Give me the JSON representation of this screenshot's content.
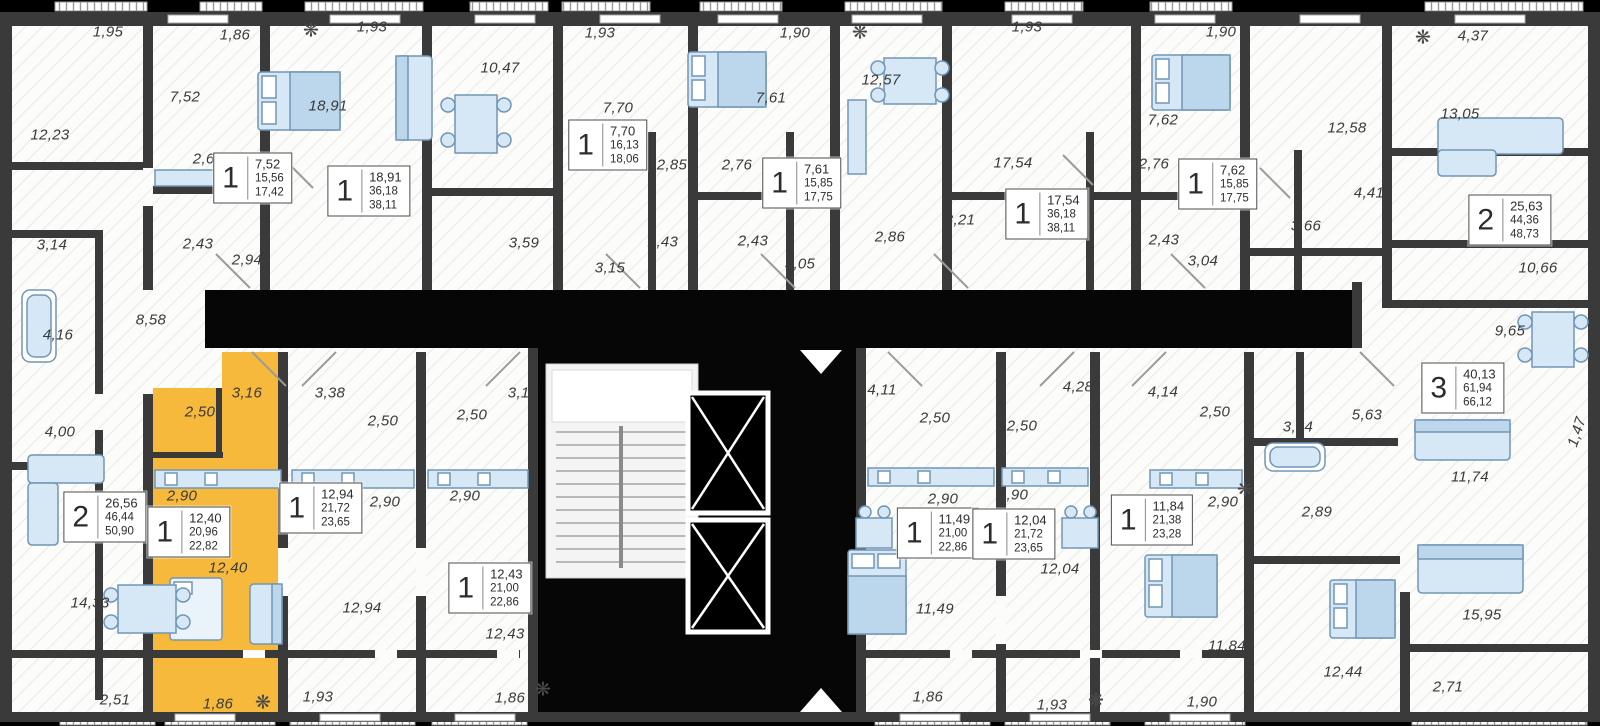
{
  "plan": {
    "type": "residential-floor-plan",
    "selected_apartment": {
      "rooms": "1",
      "areas": [
        "12,40",
        "20,96",
        "22,82"
      ]
    },
    "colors": {
      "highlight": "#F6B93C",
      "wall": "#3A3A3A",
      "shaft": "#000000",
      "furniture": "#D6E7F5"
    }
  },
  "room_labels": [
    {
      "text": "1,95",
      "x": 108,
      "y": 32
    },
    {
      "text": "1,86",
      "x": 235,
      "y": 35
    },
    {
      "text": "1,93",
      "x": 372,
      "y": 27
    },
    {
      "text": "10,47",
      "x": 500,
      "y": 68
    },
    {
      "text": "1,93",
      "x": 600,
      "y": 33
    },
    {
      "text": "1,90",
      "x": 795,
      "y": 33
    },
    {
      "text": "1,93",
      "x": 1027,
      "y": 27
    },
    {
      "text": "1,90",
      "x": 1221,
      "y": 32
    },
    {
      "text": "4,37",
      "x": 1473,
      "y": 36
    },
    {
      "text": "7,52",
      "x": 185,
      "y": 97
    },
    {
      "text": "12,23",
      "x": 50,
      "y": 135
    },
    {
      "text": "18,91",
      "x": 328,
      "y": 106
    },
    {
      "text": "7,70",
      "x": 618,
      "y": 108
    },
    {
      "text": "7,61",
      "x": 771,
      "y": 98
    },
    {
      "text": "12,57",
      "x": 881,
      "y": 80
    },
    {
      "text": "7,62",
      "x": 1163,
      "y": 120
    },
    {
      "text": "12,58",
      "x": 1347,
      "y": 128
    },
    {
      "text": "13,05",
      "x": 1460,
      "y": 114
    },
    {
      "text": "2,67",
      "x": 208,
      "y": 159
    },
    {
      "text": "2,85",
      "x": 672,
      "y": 165
    },
    {
      "text": "2,76",
      "x": 737,
      "y": 165
    },
    {
      "text": "17,54",
      "x": 1013,
      "y": 163
    },
    {
      "text": "2,76",
      "x": 1154,
      "y": 164
    },
    {
      "text": "4,41",
      "x": 1369,
      "y": 193
    },
    {
      "text": "3,66",
      "x": 1306,
      "y": 226
    },
    {
      "text": "3,14",
      "x": 52,
      "y": 245
    },
    {
      "text": "2,43",
      "x": 198,
      "y": 244
    },
    {
      "text": "2,94",
      "x": 247,
      "y": 260
    },
    {
      "text": "3,59",
      "x": 524,
      "y": 243
    },
    {
      "text": "2,43",
      "x": 663,
      "y": 242
    },
    {
      "text": "2,43",
      "x": 753,
      "y": 241
    },
    {
      "text": "2,86",
      "x": 890,
      "y": 237
    },
    {
      "text": "3,21",
      "x": 960,
      "y": 220
    },
    {
      "text": "2,43",
      "x": 1164,
      "y": 240
    },
    {
      "text": "3,04",
      "x": 1203,
      "y": 261
    },
    {
      "text": "3,15",
      "x": 610,
      "y": 268
    },
    {
      "text": "3,05",
      "x": 800,
      "y": 264
    },
    {
      "text": "8,58",
      "x": 151,
      "y": 320
    },
    {
      "text": "4,16",
      "x": 58,
      "y": 335
    },
    {
      "text": "10,66",
      "x": 1538,
      "y": 268
    },
    {
      "text": "9,65",
      "x": 1510,
      "y": 331
    },
    {
      "text": "4,00",
      "x": 60,
      "y": 432
    },
    {
      "text": "3,16",
      "x": 247,
      "y": 393
    },
    {
      "text": "2,50",
      "x": 200,
      "y": 412
    },
    {
      "text": "3,38",
      "x": 330,
      "y": 393
    },
    {
      "text": "2,50",
      "x": 383,
      "y": 421
    },
    {
      "text": "3,17",
      "x": 523,
      "y": 393
    },
    {
      "text": "2,50",
      "x": 472,
      "y": 415
    },
    {
      "text": "4,11",
      "x": 882,
      "y": 390
    },
    {
      "text": "2,50",
      "x": 935,
      "y": 418
    },
    {
      "text": "2,50",
      "x": 1022,
      "y": 426
    },
    {
      "text": "4,28",
      "x": 1078,
      "y": 387
    },
    {
      "text": "4,14",
      "x": 1163,
      "y": 392
    },
    {
      "text": "2,50",
      "x": 1215,
      "y": 412
    },
    {
      "text": "3,64",
      "x": 1298,
      "y": 427
    },
    {
      "text": "5,63",
      "x": 1367,
      "y": 415
    },
    {
      "text": "1,47",
      "x": 1577,
      "y": 432,
      "rotate": -72
    },
    {
      "text": "11,74",
      "x": 1470,
      "y": 477
    },
    {
      "text": "2,90",
      "x": 182,
      "y": 496
    },
    {
      "text": "2,90",
      "x": 385,
      "y": 502
    },
    {
      "text": "2,90",
      "x": 465,
      "y": 496
    },
    {
      "text": "2,90",
      "x": 943,
      "y": 499
    },
    {
      "text": "2,90",
      "x": 1013,
      "y": 495
    },
    {
      "text": "2,90",
      "x": 1223,
      "y": 502
    },
    {
      "text": "2,89",
      "x": 1317,
      "y": 512
    },
    {
      "text": "12,40",
      "x": 228,
      "y": 568
    },
    {
      "text": "12,94",
      "x": 362,
      "y": 608
    },
    {
      "text": "12,43",
      "x": 505,
      "y": 634
    },
    {
      "text": "11,49",
      "x": 935,
      "y": 609
    },
    {
      "text": "12,04",
      "x": 1060,
      "y": 569
    },
    {
      "text": "11,84",
      "x": 1227,
      "y": 646
    },
    {
      "text": "14,33",
      "x": 90,
      "y": 603
    },
    {
      "text": "15,95",
      "x": 1482,
      "y": 615
    },
    {
      "text": "12,44",
      "x": 1343,
      "y": 672
    },
    {
      "text": "2,51",
      "x": 115,
      "y": 700
    },
    {
      "text": "1,86",
      "x": 218,
      "y": 704
    },
    {
      "text": "1,93",
      "x": 318,
      "y": 697
    },
    {
      "text": "1,86",
      "x": 510,
      "y": 698
    },
    {
      "text": "1,86",
      "x": 928,
      "y": 697
    },
    {
      "text": "1,93",
      "x": 1052,
      "y": 705
    },
    {
      "text": "1,90",
      "x": 1202,
      "y": 702
    },
    {
      "text": "2,71",
      "x": 1448,
      "y": 687
    }
  ],
  "apartments": [
    {
      "rooms": "1",
      "values": [
        "7,52",
        "15,56",
        "17,42"
      ],
      "x": 253,
      "y": 178,
      "selected": false
    },
    {
      "rooms": "1",
      "values": [
        "18,91",
        "36,18",
        "38,11"
      ],
      "x": 369,
      "y": 191,
      "selected": false
    },
    {
      "rooms": "1",
      "values": [
        "7,70",
        "16,13",
        "18,06"
      ],
      "x": 608,
      "y": 145,
      "selected": false
    },
    {
      "rooms": "1",
      "values": [
        "7,61",
        "15,85",
        "17,75"
      ],
      "x": 802,
      "y": 183,
      "selected": false
    },
    {
      "rooms": "1",
      "values": [
        "17,54",
        "36,18",
        "38,11"
      ],
      "x": 1047,
      "y": 214,
      "selected": false
    },
    {
      "rooms": "1",
      "values": [
        "7,62",
        "15,85",
        "17,75"
      ],
      "x": 1218,
      "y": 184,
      "selected": false
    },
    {
      "rooms": "2",
      "values": [
        "25,63",
        "44,36",
        "48,73"
      ],
      "x": 1510,
      "y": 220,
      "selected": false
    },
    {
      "rooms": "3",
      "values": [
        "40,13",
        "61,94",
        "66,12"
      ],
      "x": 1463,
      "y": 388,
      "selected": false
    },
    {
      "rooms": "2",
      "values": [
        "26,56",
        "46,44",
        "50,90"
      ],
      "x": 105,
      "y": 517,
      "selected": false
    },
    {
      "rooms": "1",
      "values": [
        "12,40",
        "20,96",
        "22,82"
      ],
      "x": 189,
      "y": 532,
      "selected": true
    },
    {
      "rooms": "1",
      "values": [
        "12,94",
        "21,72",
        "23,65"
      ],
      "x": 321,
      "y": 508,
      "selected": false
    },
    {
      "rooms": "1",
      "values": [
        "12,43",
        "21,00",
        "22,86"
      ],
      "x": 490,
      "y": 588,
      "selected": false
    },
    {
      "rooms": "1",
      "values": [
        "11,49",
        "21,00",
        "22,86"
      ],
      "x": 938,
      "y": 533,
      "selected": false
    },
    {
      "rooms": "1",
      "values": [
        "12,04",
        "21,72",
        "23,65"
      ],
      "x": 1014,
      "y": 534,
      "selected": false
    },
    {
      "rooms": "1",
      "values": [
        "11,84",
        "21,38",
        "23,28"
      ],
      "x": 1152,
      "y": 520,
      "selected": false
    }
  ],
  "plants": [
    {
      "glyph": "❋",
      "x": 311,
      "y": 31
    },
    {
      "glyph": "❋",
      "x": 860,
      "y": 33
    },
    {
      "glyph": "❋",
      "x": 1423,
      "y": 38
    },
    {
      "glyph": "❋",
      "x": 263,
      "y": 703
    },
    {
      "glyph": "❋",
      "x": 543,
      "y": 690
    },
    {
      "glyph": "❋",
      "x": 1096,
      "y": 701
    },
    {
      "glyph": "❋",
      "x": 1245,
      "y": 490
    }
  ]
}
